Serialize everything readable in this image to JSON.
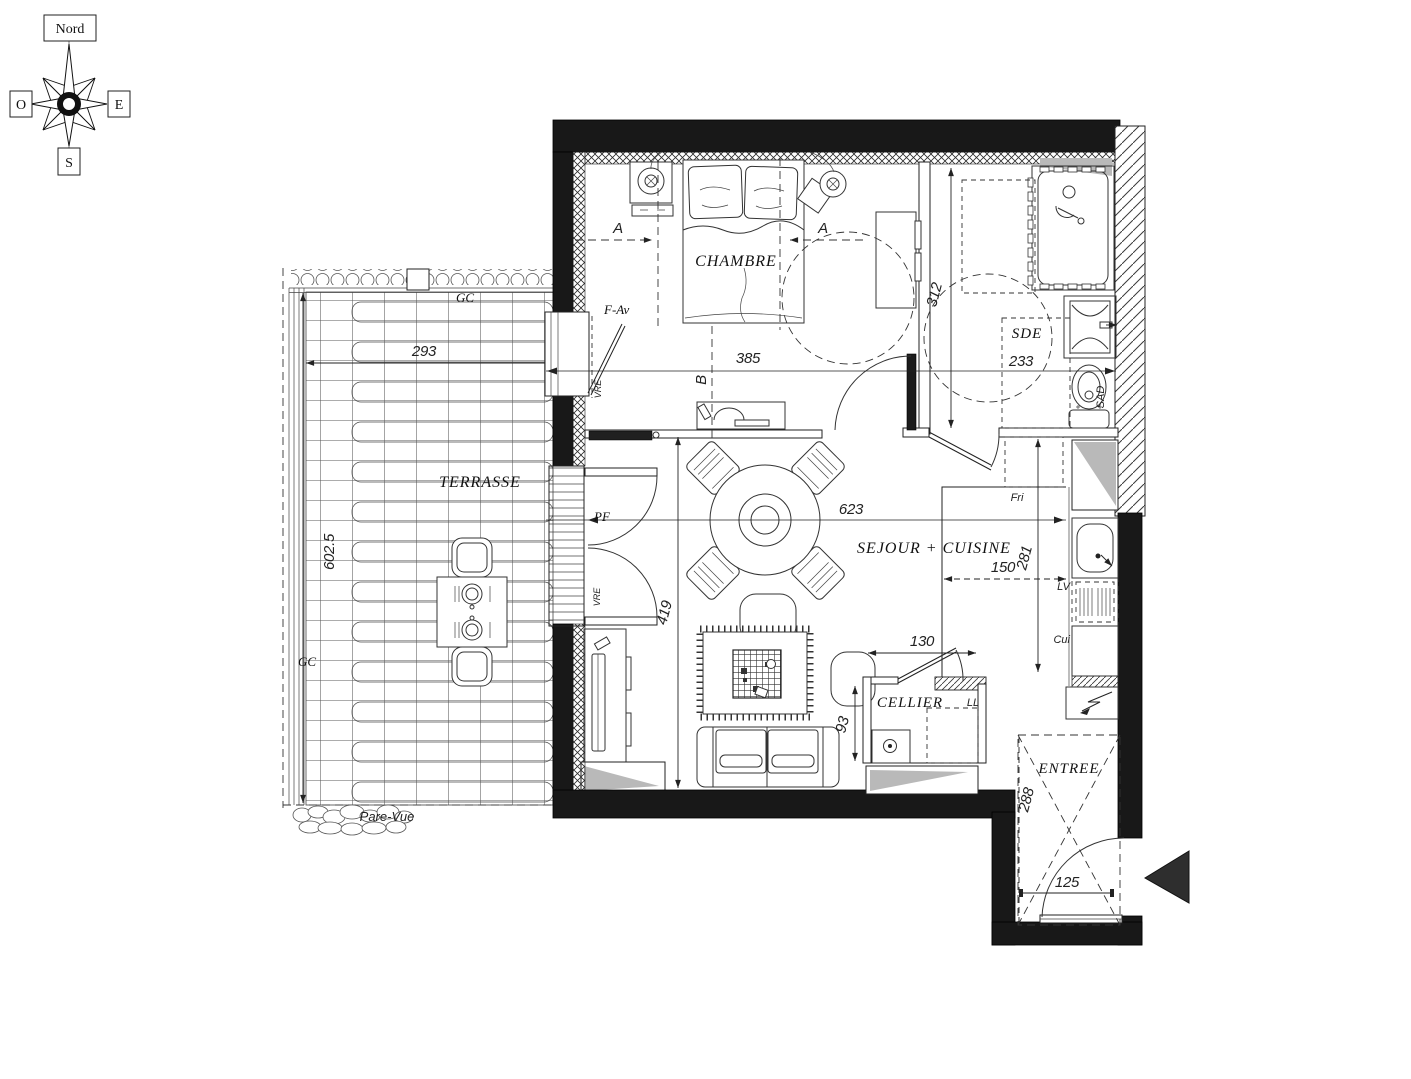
{
  "compass": {
    "north": "Nord",
    "south": "S",
    "east": "E",
    "west": "O"
  },
  "rooms": {
    "chambre": "CHAMBRE",
    "sde": "SDE",
    "sejour_cuisine": "SEJOUR + CUISINE",
    "cellier": "CELLIER",
    "entree": "ENTREE",
    "terrasse": "TERRASSE"
  },
  "dimensions": {
    "terrasse_width": "293",
    "terrasse_length": "602.5",
    "chambre_width": "385",
    "sde_width": "233",
    "sde_depth": "312",
    "sejour_width": "623",
    "sejour_depth": "419",
    "cuisine_width": "150",
    "cuisine_depth": "281",
    "cellier_width": "130",
    "cellier_depth": "93",
    "entree_depth": "288",
    "entree_width": "125"
  },
  "labels": {
    "gc_top": "GC",
    "gc_left": "GC",
    "pare_vue": "Pare-Vue",
    "f_av": "F-Av",
    "pf": "PF",
    "vre_window": "VRE",
    "vre_door": "VRE",
    "fri": "Fri",
    "lv": "LV",
    "cui": "Cui",
    "sad": "SAD",
    "ll": "LL",
    "section_a_left": "A",
    "section_a_right": "A",
    "section_b": "B"
  },
  "colors": {
    "wall": "#181818",
    "shadow": "#b9b9b9",
    "line": "#222222"
  }
}
